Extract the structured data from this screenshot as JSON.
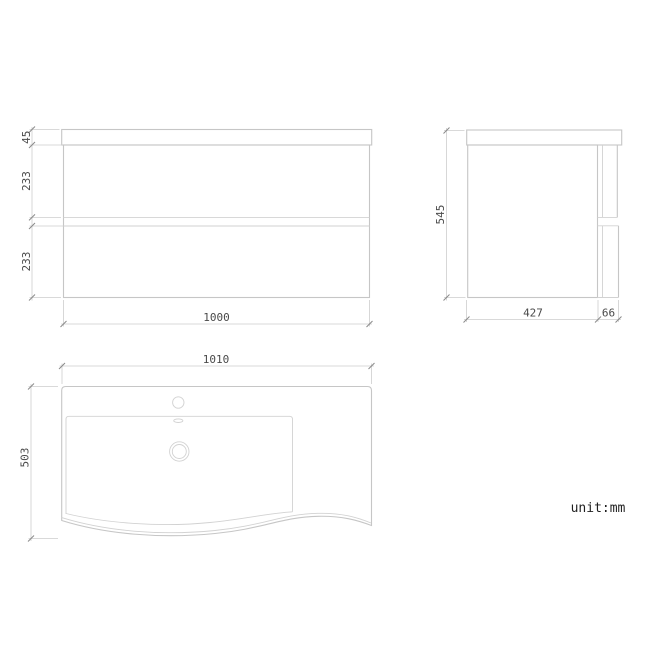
{
  "drawing": {
    "unit_label": "unit:mm",
    "views": {
      "front": {
        "dim_top_thickness": "45",
        "dim_upper_drawer": "233",
        "dim_lower_drawer": "233",
        "dim_width": "1000"
      },
      "side": {
        "dim_height": "545",
        "dim_body_depth": "427",
        "dim_front_overhang": "66"
      },
      "top": {
        "dim_width": "1010",
        "dim_depth": "503"
      }
    },
    "colors": {
      "line": "#c6c6c6",
      "dimension_text": "#4a4a4a"
    }
  }
}
